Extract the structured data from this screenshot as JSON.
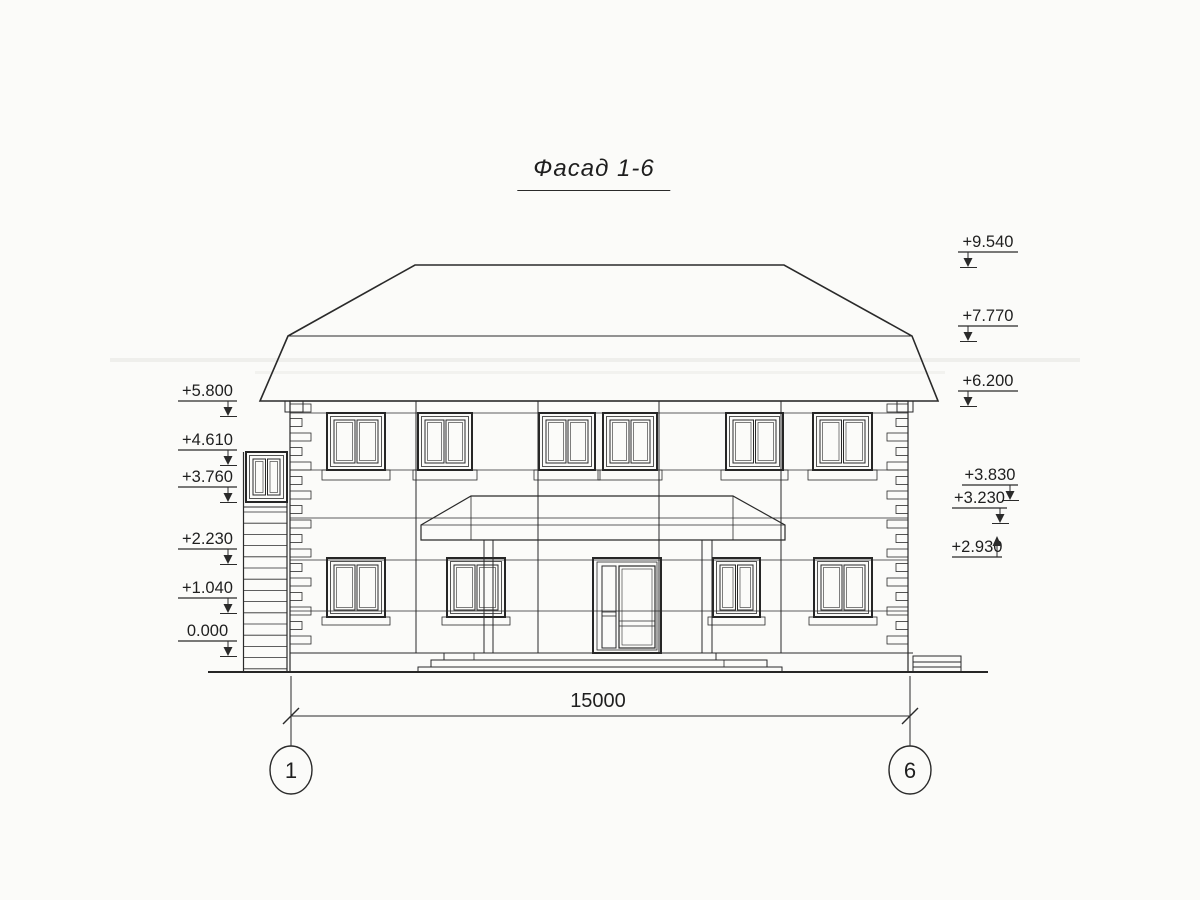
{
  "title": "Фасад 1-6",
  "elevation_marks": {
    "left": [
      "+5.800",
      "+4.610",
      "+3.760",
      "+2.230",
      "+1.040",
      "0.000"
    ],
    "right": [
      "+9.540",
      "+7.770",
      "+6.200",
      "+3.830",
      "+3.230",
      "+2.930"
    ]
  },
  "dimension": {
    "length_label": "15000"
  },
  "axes": {
    "left_label": "1",
    "right_label": "6"
  },
  "colors": {
    "ink": "#2a2a2a",
    "paper": "#fbfbf9"
  }
}
